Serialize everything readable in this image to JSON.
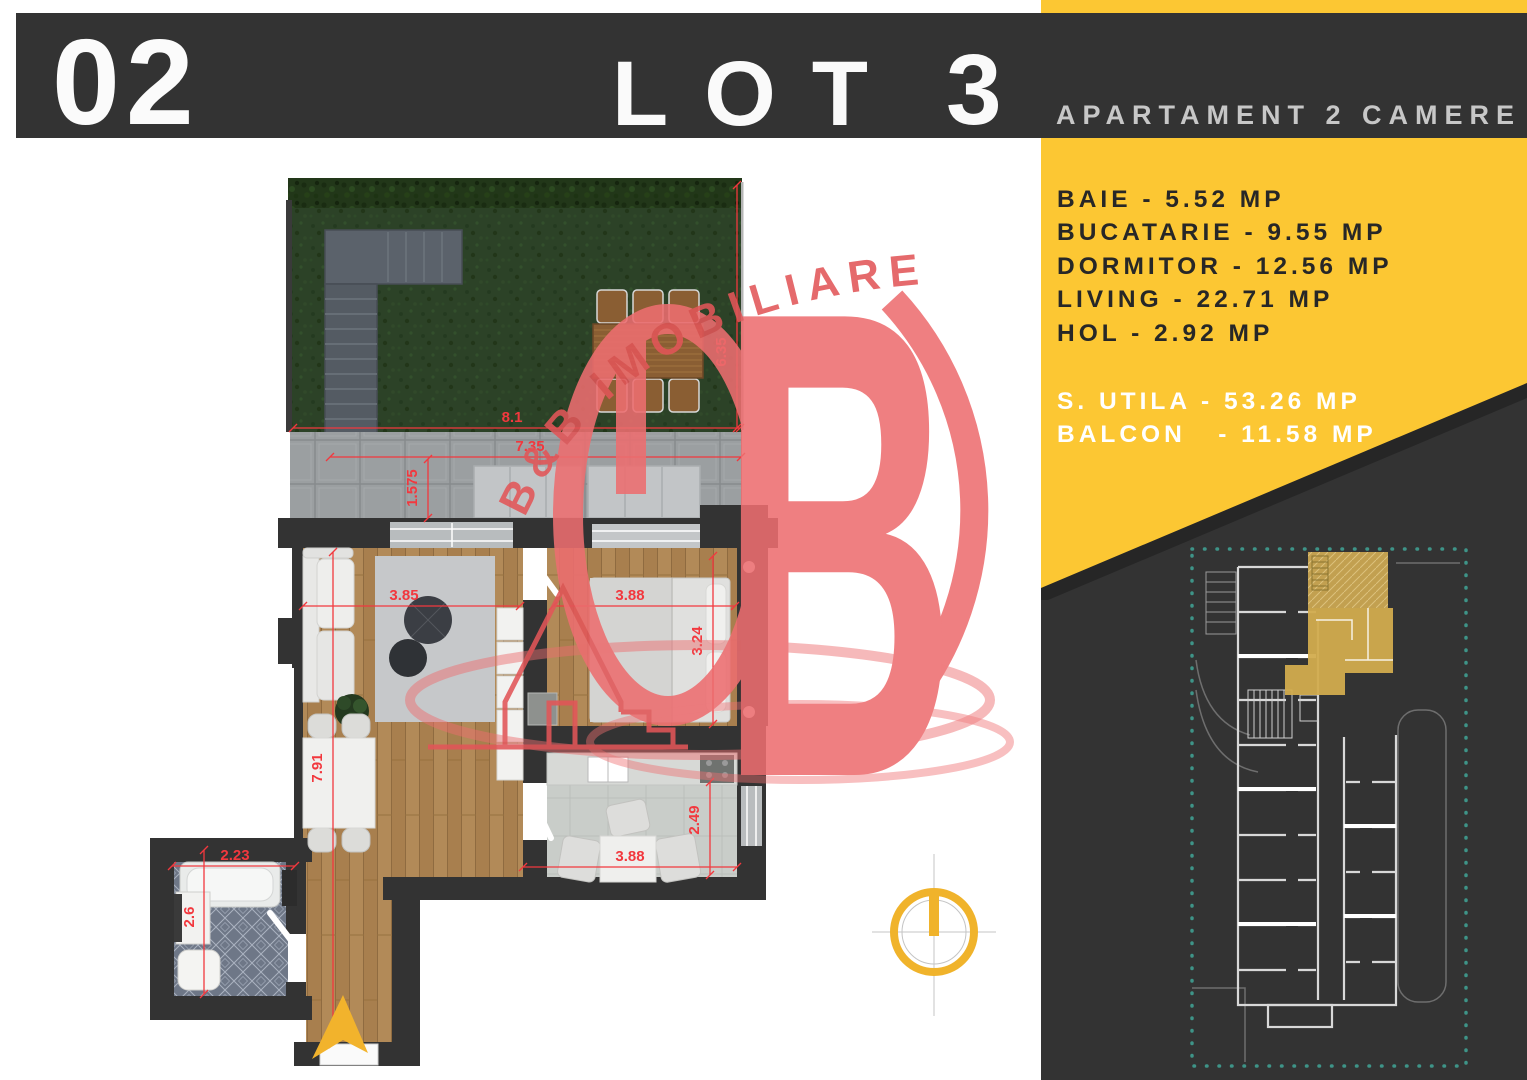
{
  "header": {
    "number": "02",
    "title_word": "LOT",
    "title_number": "3",
    "subtitle": "APARTAMENT 2 CAMERE"
  },
  "panel": {
    "rooms": [
      "BAIE - 5.52 MP",
      "BUCATARIE - 9.55 MP",
      "DORMITOR - 12.56 MP",
      "LIVING - 22.71 MP",
      "HOL - 2.92 MP"
    ],
    "totals": [
      "S. UTILA - 53.26 MP",
      "BALCON   - 11.58 MP"
    ]
  },
  "watermark": {
    "arc_text": "B&B IMOBILIARE",
    "big_letter": "B"
  },
  "dimensions": {
    "garden_width": "8.1",
    "terrace_width": "7.35",
    "garden_height": "6.35",
    "terrace_depth": "1.575",
    "living_width": "3.85",
    "living_length": "7.91",
    "bedroom_width": "3.88",
    "bedroom_length": "3.24",
    "kitchen_width": "3.88",
    "kitchen_depth": "2.49",
    "bath_width": "2.23",
    "bath_depth": "2.6"
  },
  "colors": {
    "accent_yellow": "#FCC733",
    "band_dark": "#333333",
    "watermark_red": "#ED6E70",
    "dimension_red": "#F2383E",
    "site_boundary_teal": "#3E9488",
    "highlight_unit_yellow": "#D2AC4E"
  }
}
